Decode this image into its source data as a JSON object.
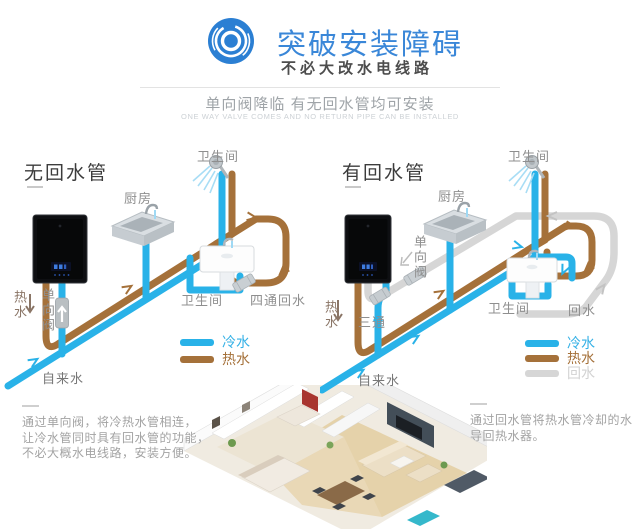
{
  "header": {
    "title": "突破安装障碍",
    "subtitle": "不必大改水电线路",
    "tagline_cn": "单向阀降临 有无回水管均可安装",
    "tagline_en": "ONE WAY VALVE COMES AND NO RETURN PIPE CAN BE INSTALLED",
    "accent_color": "#3a87d8"
  },
  "colors": {
    "cold": "#29b2e8",
    "hot": "#a5713a",
    "return": "#d6d6d6"
  },
  "diagram_left": {
    "title": "无回水管",
    "labels": {
      "bathroom_top": "卫生间",
      "kitchen": "厨房",
      "hot_water": "热水",
      "check_valve": "单向阀",
      "tap_water": "自来水",
      "bathroom": "卫生间",
      "four_way_return": "四通回水"
    },
    "legend": [
      {
        "label": "冷水",
        "color": "#29b2e8"
      },
      {
        "label": "热水",
        "color": "#a5713a"
      }
    ]
  },
  "diagram_right": {
    "title": "有回水管",
    "labels": {
      "bathroom_top": "卫生间",
      "kitchen": "厨房",
      "check_valve": "单向阀",
      "tee": "三通",
      "hot_water": "热水",
      "tap_water": "自来水",
      "bathroom": "卫生间",
      "return_water": "回水"
    },
    "legend": [
      {
        "label": "冷水",
        "color": "#29b2e8"
      },
      {
        "label": "热水",
        "color": "#a5713a"
      },
      {
        "label": "回水",
        "color": "#d6d6d6"
      }
    ]
  },
  "footnotes": {
    "left": [
      "通过单向阀，将冷热水管相连，",
      "让冷水管同时具有回水管的功能，",
      "不必大概水电线路，安装方便。"
    ],
    "right": [
      "通过回水管将热水管冷却的水",
      "导回热水器。"
    ]
  }
}
